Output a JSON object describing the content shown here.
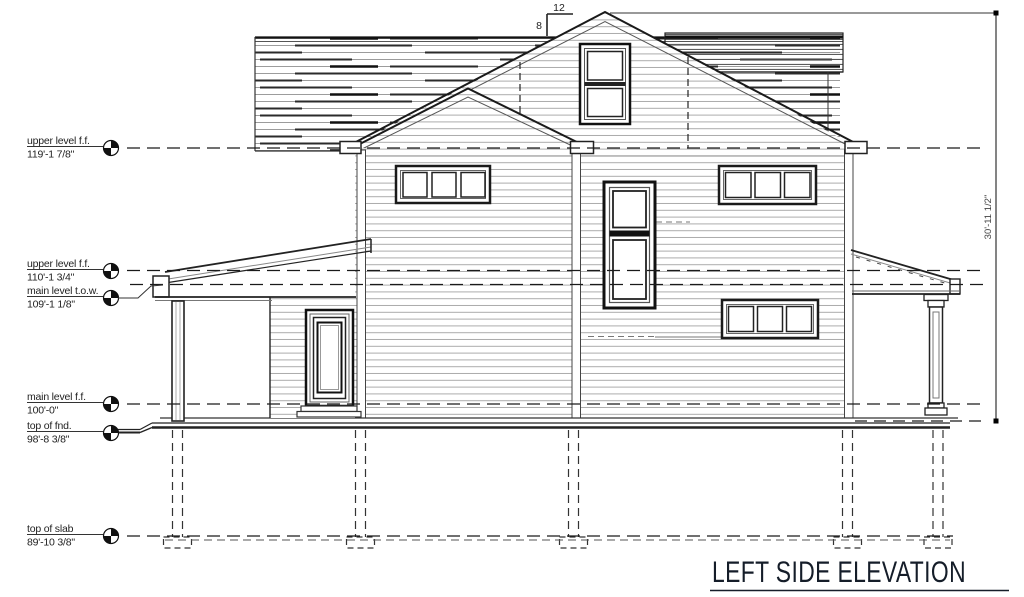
{
  "drawing_title": {
    "label": "LEFT SIDE ELEVATION"
  },
  "pitch_marker": {
    "run": "12",
    "rise": "8"
  },
  "dimension": {
    "overall_height": "30'-11 1/2\""
  },
  "levels": [
    {
      "name": "upper level f.f.",
      "elevation": "119'-1 7/8\""
    },
    {
      "name": "upper level f.f.",
      "elevation": "110'-1 3/4\""
    },
    {
      "name": "main level t.o.w.",
      "elevation": "109'-1 1/8\""
    },
    {
      "name": "main level f.f.",
      "elevation": "100'-0\""
    },
    {
      "name": "top of fnd.",
      "elevation": "98'-8 3/8\""
    },
    {
      "name": "top of slab",
      "elevation": "89'-10 3/8\""
    }
  ]
}
